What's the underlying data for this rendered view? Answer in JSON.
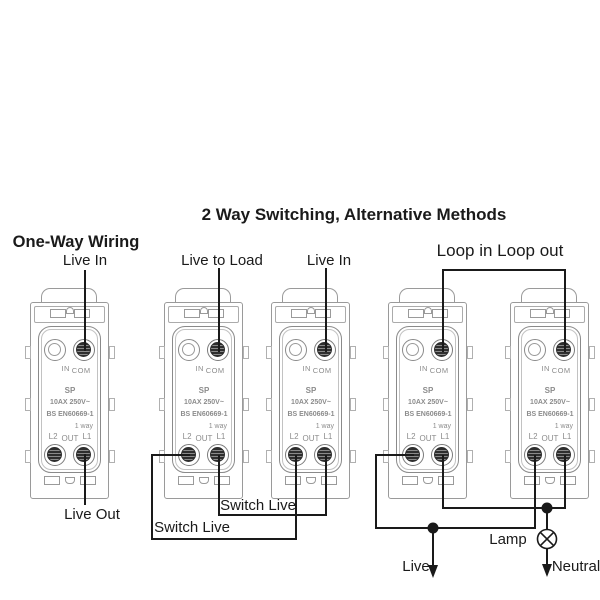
{
  "titles": {
    "one_way": "One-Way Wiring",
    "two_way": "2 Way Switching, Alternative Methods",
    "loop": "Loop in Loop out"
  },
  "wire_labels": {
    "m1_live_in": "Live In",
    "m1_live_out": "Live Out",
    "m2_live_to_load": "Live to Load",
    "m3_live_in": "Live In",
    "switch_live_upper": "Switch Live",
    "switch_live_lower": "Switch Live",
    "live": "Live",
    "lamp": "Lamp",
    "neutral": "Neutral"
  },
  "module_text": {
    "in": "IN",
    "com": "COM",
    "sp": "SP",
    "rating": "10AX 250V~",
    "standard": "BS EN60669-1",
    "way": "1 way",
    "l2": "L2",
    "out": "OUT",
    "l1": "L1"
  },
  "module_count": 5,
  "colors": {
    "background": "#ffffff",
    "wire": "#1a1a1a",
    "module_outline": "#9a9a9a",
    "module_text": "#8c8c8c"
  }
}
